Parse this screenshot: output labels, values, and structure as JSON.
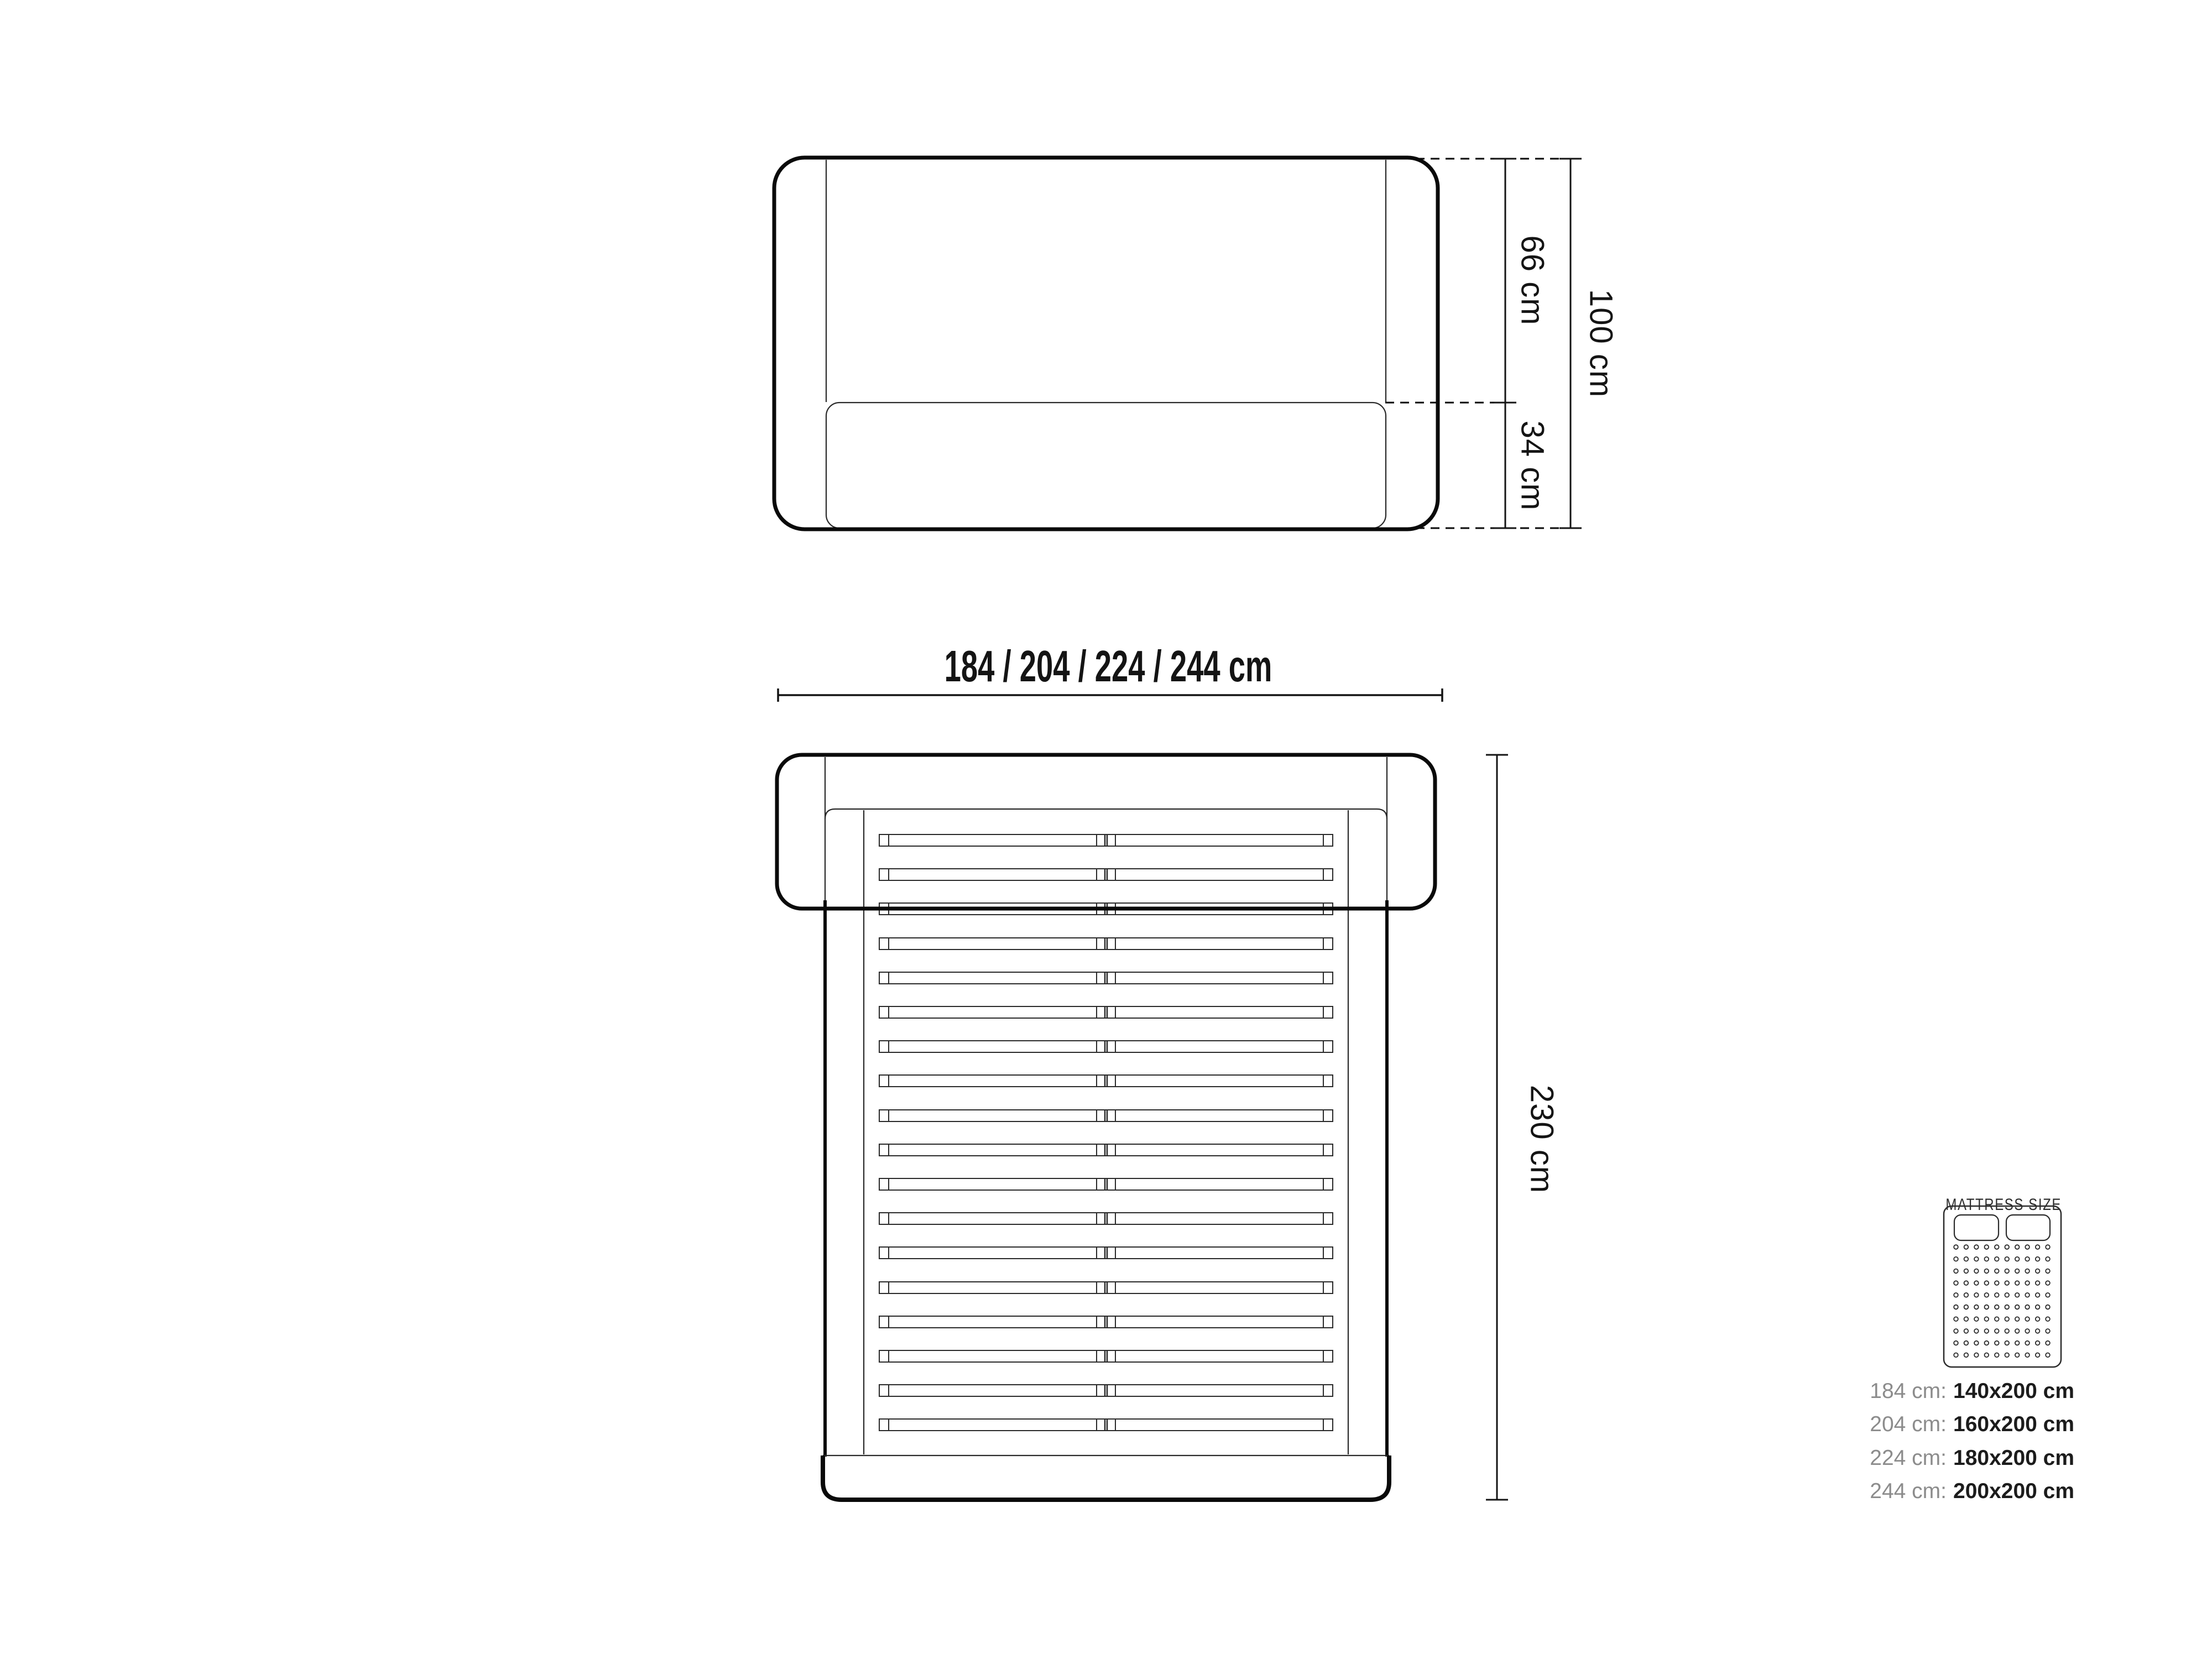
{
  "drawing_type": "bed technical dimension drawing",
  "front_view": {
    "dim_height_upper": "66 cm",
    "dim_height_lower": "34 cm",
    "dim_height_total": "100 cm"
  },
  "width_dimension": {
    "label": "184 / 204 / 224 / 244 cm"
  },
  "top_view": {
    "dim_length": "230 cm",
    "slat_count": 18
  },
  "legend": {
    "title": "MATTRESS SIZE",
    "rows": [
      {
        "label": "184 cm:",
        "value": "140x200 cm"
      },
      {
        "label": "204 cm:",
        "value": "160x200 cm"
      },
      {
        "label": "224 cm:",
        "value": "180x200 cm"
      },
      {
        "label": "244 cm:",
        "value": "200x200 cm"
      }
    ]
  },
  "colors": {
    "ink": "#0a0a0a",
    "thin_line": "#2a2a2a",
    "label_gray": "#8c8c8c",
    "value_dark": "#1c1c1c",
    "background": "#ffffff"
  }
}
